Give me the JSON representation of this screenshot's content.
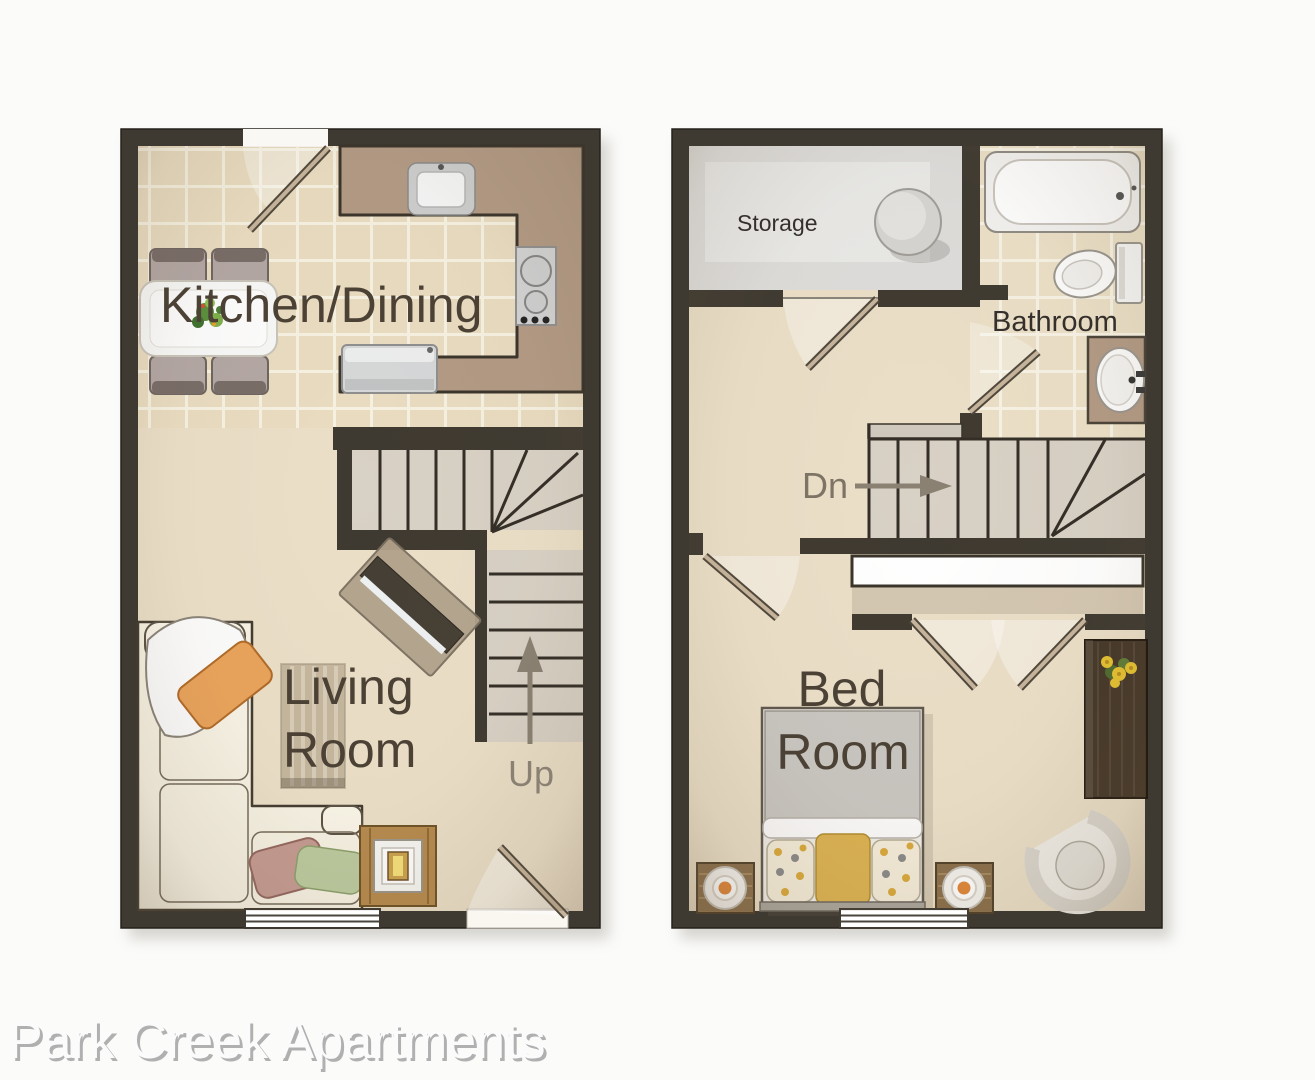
{
  "footer": {
    "title": "Park Creek Apartments"
  },
  "first_floor": {
    "labels": {
      "kitchen_dining": "Kitchen/Dining",
      "living_line1": "Living",
      "living_line2": "Room",
      "stair_direction": "Up"
    }
  },
  "second_floor": {
    "labels": {
      "storage": "Storage",
      "bathroom": "Bathroom",
      "stair_direction": "Dn",
      "bed_line1": "Bed",
      "bed_line2": "Room"
    }
  },
  "colors": {
    "background": "#fbfbfa",
    "wall": "#3f3a31",
    "tile_floor": "#e9dcc0",
    "grout": "#f6f1e1",
    "cream_floor": "#ebdfc8",
    "storage_floor": "#dedddb",
    "counter": "#b29a84",
    "stair_tread": "#d8d1c5",
    "room_label": "#4b4135",
    "small_label": "#35302b",
    "direction_label": "#8a8173",
    "accent_pillow_yellow": "#dcb252",
    "accent_pillow_orange": "#e9a35b",
    "footer_text": "#fbfbfb"
  }
}
